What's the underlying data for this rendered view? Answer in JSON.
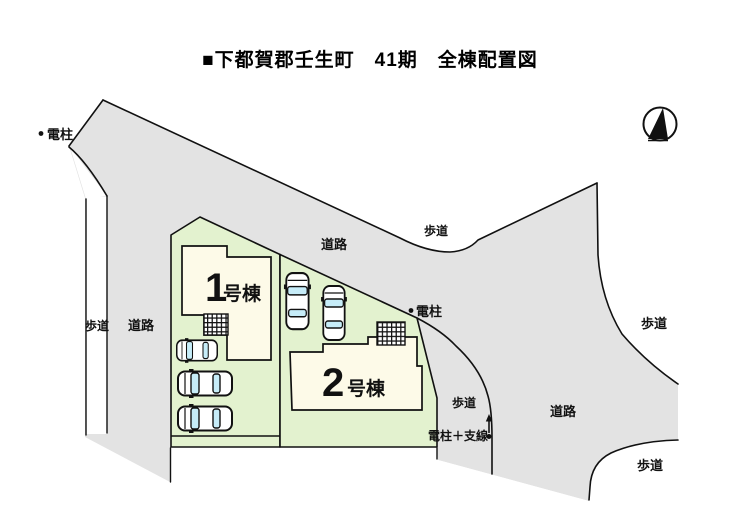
{
  "title": "■下都賀郡壬生町　41期　全棟配置図",
  "map": {
    "labels": {
      "road": "道路",
      "sidewalk": "歩道",
      "utility_pole": "電柱",
      "utility_pole_guy_wire": "電柱＋支線"
    },
    "buildings": [
      {
        "number": "1",
        "suffix": "号棟",
        "label": "1号棟"
      },
      {
        "number": "2",
        "suffix": "号棟",
        "label": "2号棟"
      }
    ],
    "colors": {
      "road": "#e3e3e3",
      "lot": "#e3f2cf",
      "building": "#fdfae8",
      "car_glass": "#c6ecf8",
      "line": "#111111"
    }
  }
}
